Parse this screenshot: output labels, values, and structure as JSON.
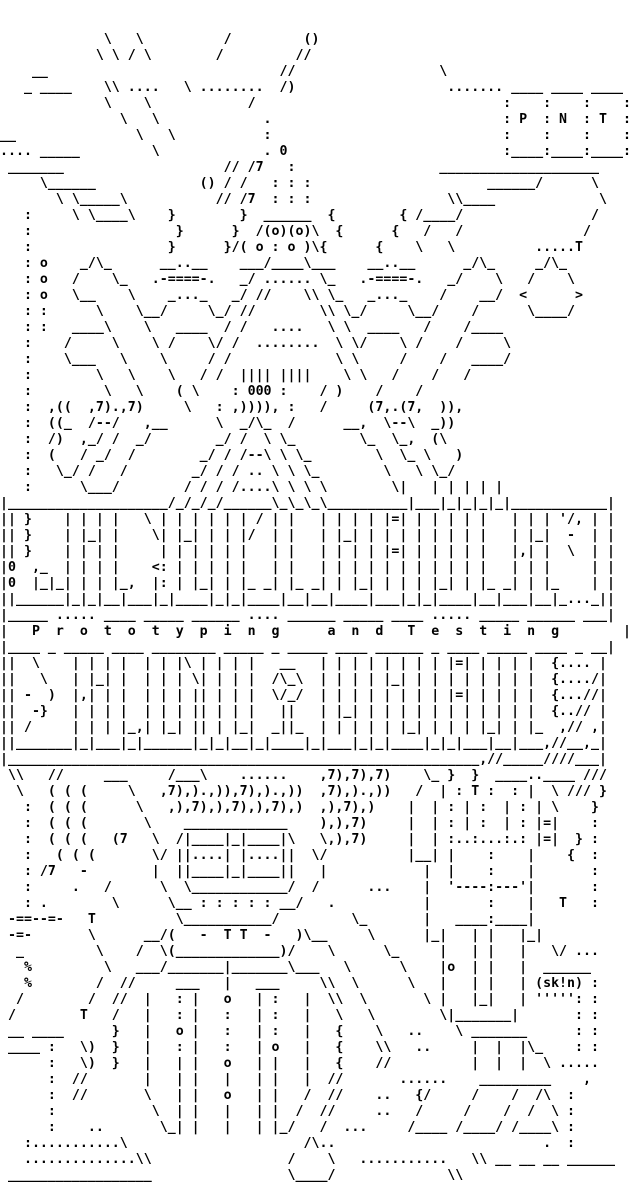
{
  "artwork": {
    "title": "Prototyping and Testing",
    "banner_text": "P r o t o t y p i n g   a n d   T e s t i n g",
    "tag_letters": [
      "P",
      "N",
      "T"
    ],
    "artist_signature": "(sk!n)",
    "colors": {
      "foreground": "#000000",
      "background": "#ffffff"
    },
    "grid": {
      "columns": 80,
      "rows": 74
    },
    "lines": [
      "",
      "",
      "             \\   \\          /         ()",
      "            \\ \\ / \\        /         //",
      "    __                             //                  \\",
      "   _ ____    \\\\ ....   \\ ........  /)                   ....... ____ ____ ____",
      "             \\    \\            /                               :    :    :    :",
      "               \\   \\             .                             : P  : N  : T  :",
      "__               \\   \\           :                             :    :    :    :",
      ".... _____         \\             . 0                           :____:____:____:",
      " _______                    // /7   :                  ____________________",
      "     \\______             () / /   : : :                      ______/      \\",
      "       \\ \\_____\\           // /7  : : :                 \\\\____             \\",
      "   :     \\ \\____\\    }        }  ______  {        { /____/                /",
      "   :                  }      }  /(o)(o)\\  {      {   /   /               /",
      "   :                 }      }/( o : o )\\{      {    \\   \\          .....T",
      "   : o    _/\\_      __..__    ___/____\\___    __..__      _/\\_     _/\\_",
      "   : o   /    \\_   .-====-.   _/ ...... \\_   .-====-.   _/    \\   /    \\",
      "   : o   \\__    \\    _..._   _/ //    \\\\ \\_   _..._    /    __/  <      >",
      "   : :      \\    \\__/     \\_/ //        \\\\ \\_/     \\__/    /      \\____/",
      "   : :   ____\\    \\   ____  / /   ....   \\ \\  ____   /    /____",
      "   :    /     \\    \\ /    \\/ /  ........  \\ \\/    \\ /    /     \\",
      "   :    \\___   \\    \\     / /             \\ \\     /    /   ____/",
      "   :        \\   \\    \\   / /  |||| ||||    \\ \\   /    /   /",
      "   :         \\   \\    ( \\    : 000 :    / )    /    /",
      "   :  ,((  ,7).,7)     \\   : ,)))), :   /     (7,.(7,  )),",
      "   :  ((_  /--/   ,__      \\  _/\\_  /      __,  \\--\\  _))",
      "   :  /)  ,_/ /  _/        _/ /  \\ \\_        \\_  \\_,  (\\",
      "   :  (   / _/  /        _/ / /--\\ \\ \\_        \\  \\_ \\   )",
      "   :   \\_/ /   /        _/ / / .. \\ \\ \\_        \\   \\ \\_/",
      "   :      \\___/        / / / /....\\ \\ \\ \\        \\|   | | | | |",
      "|____________________/_/_/_/______\\_\\_\\_\\__________|___|_|_|_|_|____________|",
      "|| }    | | | |   \\ | | | | | | / | |   | | | | |=| | | | | |   | | | '/, | |",
      "|| }    | |_| |    \\| |_| | | |/  | |   | |_| | | | | | | | |   | |_|  -  | |",
      "|| }    | | | |     | | | | | |   | |   | | | | |=| | | | | |   |,| |  \\  | |",
      "|0  ,_  | | | |    <: | | | | |   | |   | | | | | | | | | | |   | | |     | |",
      "|0  |_|_| | | |_,  |: | |_| | |_ _| |_ _| | |_| | | | |_| | |_ _| | |_    | |",
      "||______|_|_|__|___|_|____|_|_|____|__|__|____|___|_|_|____|__|___|__|_..._||",
      "|_____ ..... ____ _____ ______ .... ______ _____ ____ ..... _____ ______ ___|",
      "|   P  r  o  t  o  t  y  p  i  n  g      a  n  d   T  e  s  t  i  n  g        |",
      "|____ _ _____ ____ ________ _____ _ _____ ____ ______ _ ____ _____ ____ _ __|",
      "||  \\    | | | |  | | |\\ | | | |   __   | | | | | | | | |=| | | | |  {.... |",
      "||   \\   | |_| |  | | | \\| | | |  /\\_\\  | | | | |_| | | | | | | | |  {..../|",
      "|| -  )  |,| | |  | | | || | | |  \\/_/  | | | | | | | | |=| | | | |  {...//|",
      "||  -}   | | | |  | | | || | | |   ||   | |_| | | | | | | | | | | |  {..// |",
      "|| /     | | | |_,| |_| || | |_|  _||_  | | | | | |_| | | | |_| | |_  ,// ,|",
      "||_______|_|___|_|______|_|_|__|_|____|_|___|_|_|____|_|_|___|__|___,//__,_|",
      "|___________________________________________________________,//_____////___|",
      " \\\\   //     ___     /___\\    ......    ,7),7),7)    \\_ }  }  ____..____ ///",
      "  \\   ( ( (     \\   ,7),).,)),7),).,))  ,7),).,))   /  | : T :  : |  \\ /// }",
      "   :  ( ( (      \\   ,),7),),7),),7),)  ,),7),)    |  | : | :  | : | \\    }",
      "   :  ( ( (       \\    _____________    ),),7)     |  | : | :  | : |=|    :",
      "   :  ( ( (   (7   \\  /|____|_|____|\\   \\,),7)     |  | :..:...:.: |=|  } :",
      "   :   ( ( (       \\/ ||....| |....||  \\/          |__| |    :    |    {  :",
      "   : /7   -        |  ||____|_|____||   |            |  |    :    |       :",
      "   :     .   /      \\  \\____________/  /      ...    |  '----:---'|       :",
      "   : .        \\      \\__ : : : : : __/   .           |       :    |   T   :",
      " -==--=-   T          \\___________/         \\_       |   ____:____|",
      " -=-       \\      __/(   -  T T  -   )\\__     \\      |_|   | |   |_|",
      "  _         \\    /  \\(_____________)/    \\      \\_     |   | |   |   \\/ ...",
      "   %         \\   ___/_______|_______\\___   \\      \\    |o  | |   |  ______",
      "   %        /  //     ___   |   ___     \\\\  \\      \\   |   | |   | (sk!n) :",
      "  /        /  //  |   : |   o   | :   |  \\\\  \\       \\ |   |_|   | ''''': :",
      " /        T   /   |   : |   :   | :   |   \\   \\        \\|_______|       : :",
      " __ ____      }   |   o |   :   | :   |   {    \\   ..    \\ _______      : :",
      " ____ :   \\)  }   |   : |   :   | o   |   {    \\\\   ..     |  |  |\\_    : :",
      "      :   \\)  }   |   | |   o   | |   |   {    //          |  |  |  \\ .....",
      "      :  //       |   | |   |   | |   |  //       ......    _________    ,",
      "      :  //       \\   | |   o   | |   /  //    ..   {/     /    /  /\\  :",
      "      :            \\  | |   |   | |  /  //     ..   /     /    /  /  \\ :",
      "      :    ..       \\_| |   |   | |_/   /  ...     /____ /____/ /____\\ :",
      "   :...........\\                      /\\..                          .  :",
      "   ..............\\\\                 /    \\   ...........   \\\\ __ __ __ ______",
      " __________________                 \\____/              \\\\"
    ]
  }
}
